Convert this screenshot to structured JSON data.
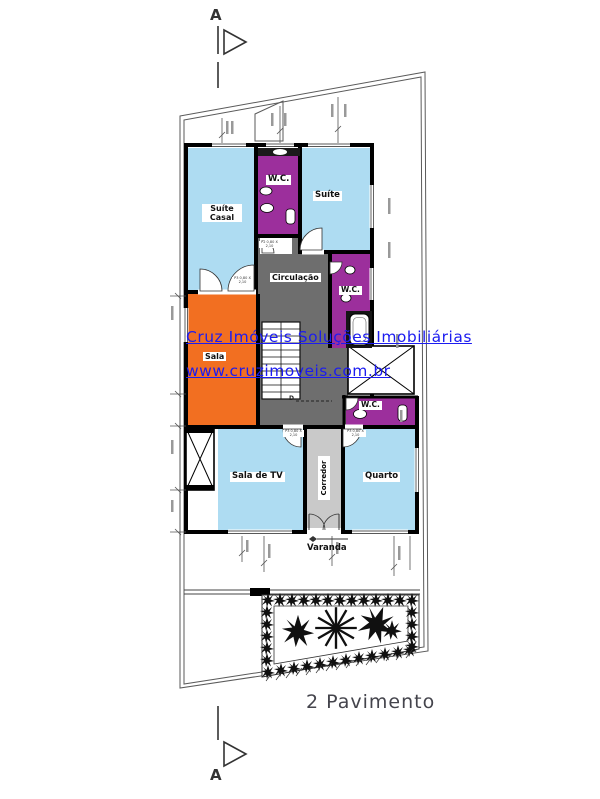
{
  "title": "2 Pavimento",
  "section_markers": {
    "top": "A",
    "bottom": "A"
  },
  "watermark": {
    "line1": "Cruz Imóveis Soluções Imobiliárias",
    "line2": "www.cruzimoveis.com.br",
    "color": "#1c1cf0"
  },
  "rooms": {
    "suite_casal": {
      "label": "Suíte Casal",
      "color": "#aedcf2"
    },
    "wc_top": {
      "label": "W.C.",
      "color": "#9c2f9c"
    },
    "suite": {
      "label": "Suíte",
      "color": "#aedcf2"
    },
    "circulacao": {
      "label": "Circulação",
      "color": "#6e6e6e"
    },
    "wc_mid": {
      "label": "W.C.",
      "color": "#9c2f9c"
    },
    "sala": {
      "label": "Sala",
      "color": "#f26f21"
    },
    "wc_low": {
      "label": "W.C.",
      "color": "#9c2f9c"
    },
    "sala_tv": {
      "label": "Sala de TV",
      "color": "#aedcf2"
    },
    "corredor": {
      "label": "Corredor",
      "color": "#c9c9c9"
    },
    "quarto": {
      "label": "Quarto",
      "color": "#aedcf2"
    },
    "varanda": {
      "label": "Varanda"
    }
  },
  "stairs": {
    "down_label": "D"
  },
  "doors": {
    "tag_p3": "P3 0,80 X 2,10",
    "tag_p2": "P2 0,80 X 2,10"
  }
}
